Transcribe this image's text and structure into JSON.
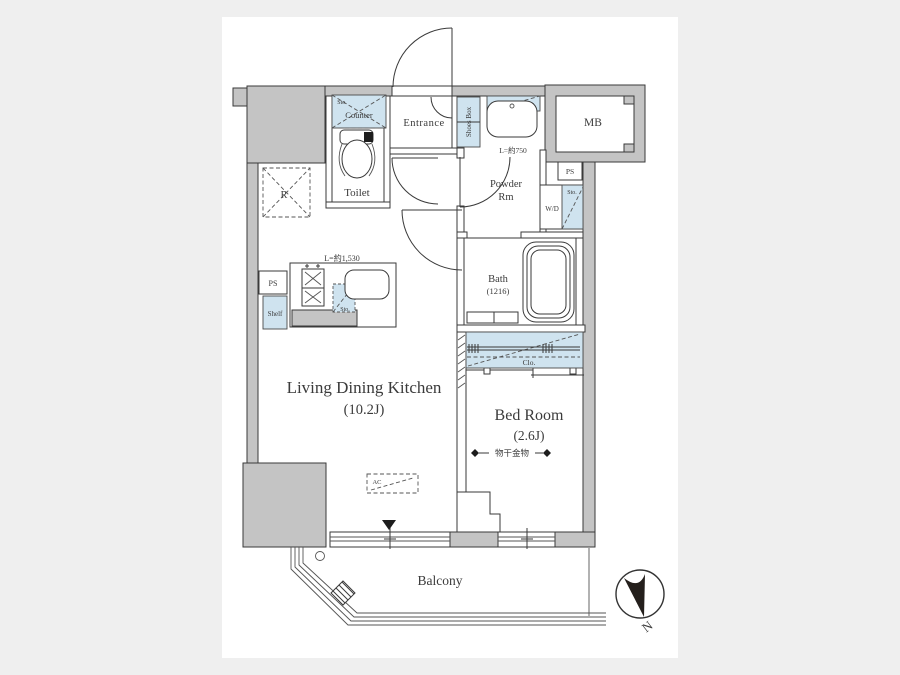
{
  "labels": {
    "ldk_name": "Living Dining Kitchen",
    "ldk_size": "(10.2J)",
    "bedroom_name": "Bed Room",
    "bedroom_size": "(2.6J)",
    "laundry_fitting": "物干金物",
    "balcony": "Balcony",
    "entrance": "Entrance",
    "toilet": "Toilet",
    "powder_line1": "Powder",
    "powder_line2": "Rm",
    "bath": "Bath",
    "bath_size": "(1216)",
    "mb": "MB",
    "ps": "PS",
    "shelf": "Shelf",
    "fridge": "R",
    "sto": "Sto.",
    "counter": "Counter",
    "shoes_box": "Shoes Box",
    "wd": "W/D",
    "closet": "Clo.",
    "ac": "AC",
    "kitchen_length": "L=約1,530",
    "basin_length": "L=約750",
    "north": "N"
  },
  "colors": {
    "background": "#efefef",
    "paper": "#ffffff",
    "wall": "#c4c4c4",
    "fixture_blue": "#cfe3ef",
    "line": "#3a3a3a"
  }
}
